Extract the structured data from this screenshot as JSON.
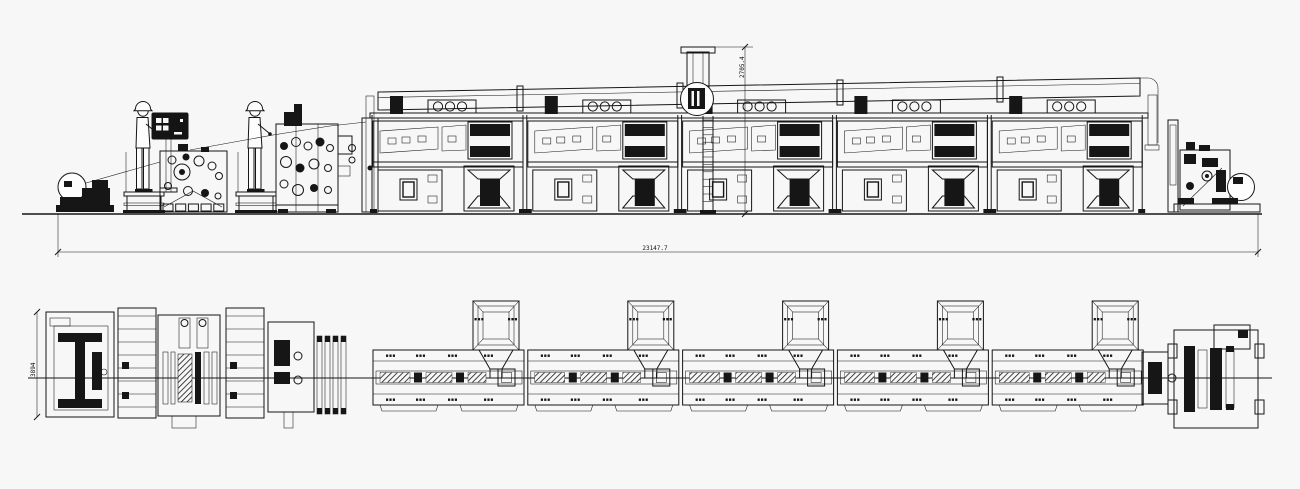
{
  "drawing": {
    "background_color": "#f7f7f7",
    "line_color": "#161616",
    "view_count": 2
  },
  "dimensions": {
    "overall_length": "23147.7",
    "line_height": "2705.4",
    "plan_width": "3894"
  },
  "oven": {
    "module_count": 5,
    "origin_x": 372,
    "module_pitch": 154.8,
    "hood_offset": 124
  },
  "operators": {
    "count": 2,
    "positions_x": [
      143,
      255
    ]
  }
}
